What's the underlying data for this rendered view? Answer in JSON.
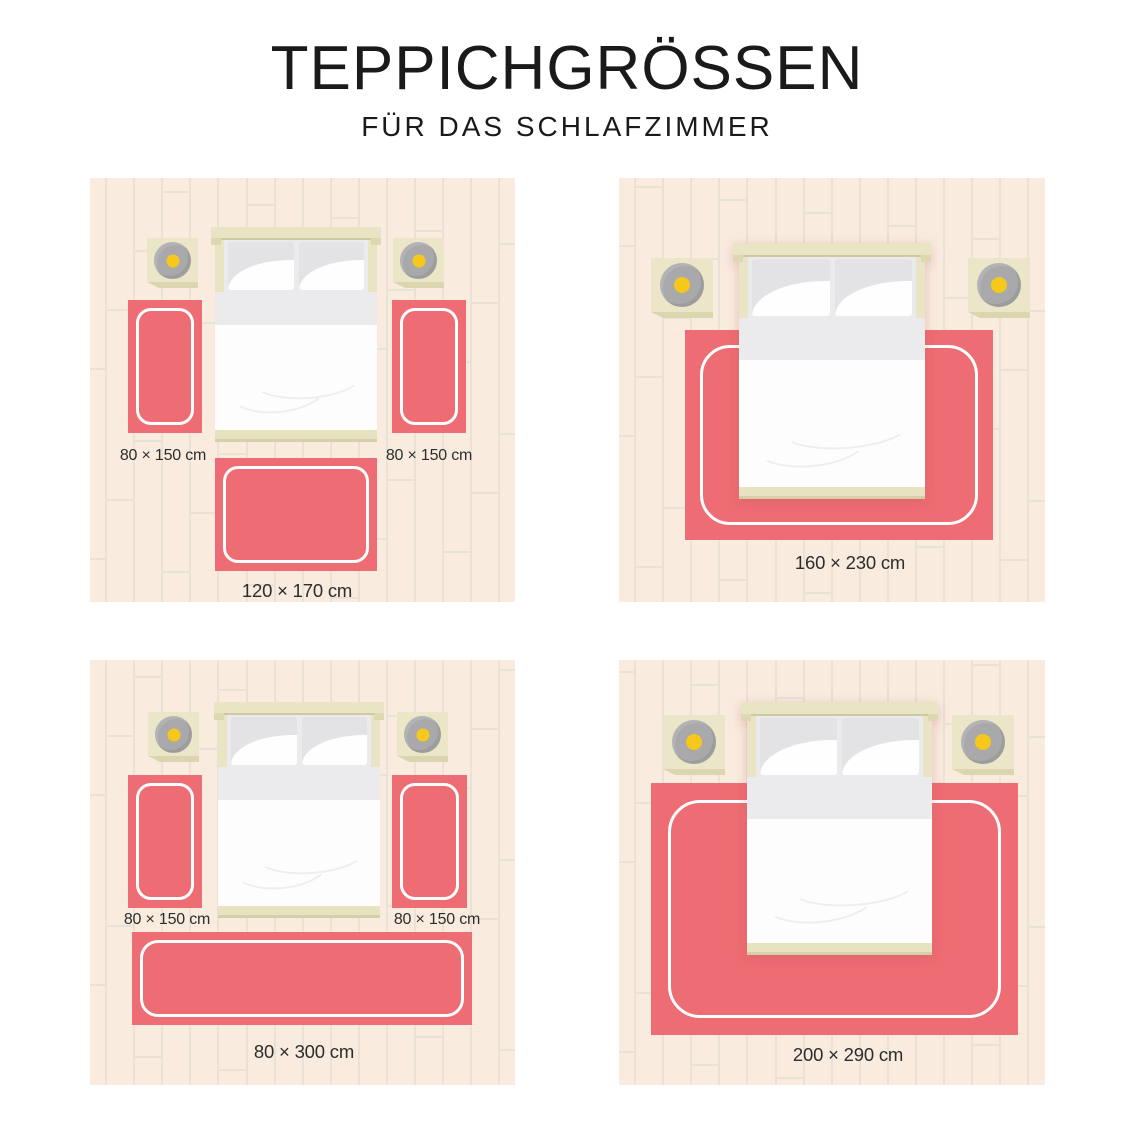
{
  "header": {
    "title": "TEPPICHGRÖSSEN",
    "subtitle": "FÜR DAS SCHLAFZIMMER"
  },
  "colors": {
    "rug": "#ee6c73",
    "rug_inner_line": "#ffffff",
    "floor": "#f9ecdf",
    "floor_line": "#e9e2d7",
    "wood_light": "#eae6c7",
    "wood_dark": "#dbd5b0",
    "lamp_gray": "#a9a9ab",
    "lamp_yellow": "#f5c81b",
    "label_text": "#2d2d2d",
    "title_text": "#1a1a1a"
  },
  "panels": [
    {
      "name": "bed-with-two-runners-and-foot-rug",
      "rugs": [
        {
          "position": "left-of-bed",
          "size": "80 × 150 cm"
        },
        {
          "position": "right-of-bed",
          "size": "80 × 150 cm"
        },
        {
          "position": "foot-of-bed",
          "size": "120 × 170 cm"
        }
      ]
    },
    {
      "name": "bed-on-medium-rug",
      "rugs": [
        {
          "position": "under-bed",
          "size": "160 × 230 cm"
        }
      ]
    },
    {
      "name": "bed-with-two-runners-and-wide-foot-runner",
      "rugs": [
        {
          "position": "left-of-bed",
          "size": "80 × 150 cm"
        },
        {
          "position": "right-of-bed",
          "size": "80 × 150 cm"
        },
        {
          "position": "foot-of-bed",
          "size": "80 × 300 cm"
        }
      ]
    },
    {
      "name": "bed-on-large-rug",
      "rugs": [
        {
          "position": "under-bed",
          "size": "200 × 290 cm"
        }
      ]
    }
  ]
}
